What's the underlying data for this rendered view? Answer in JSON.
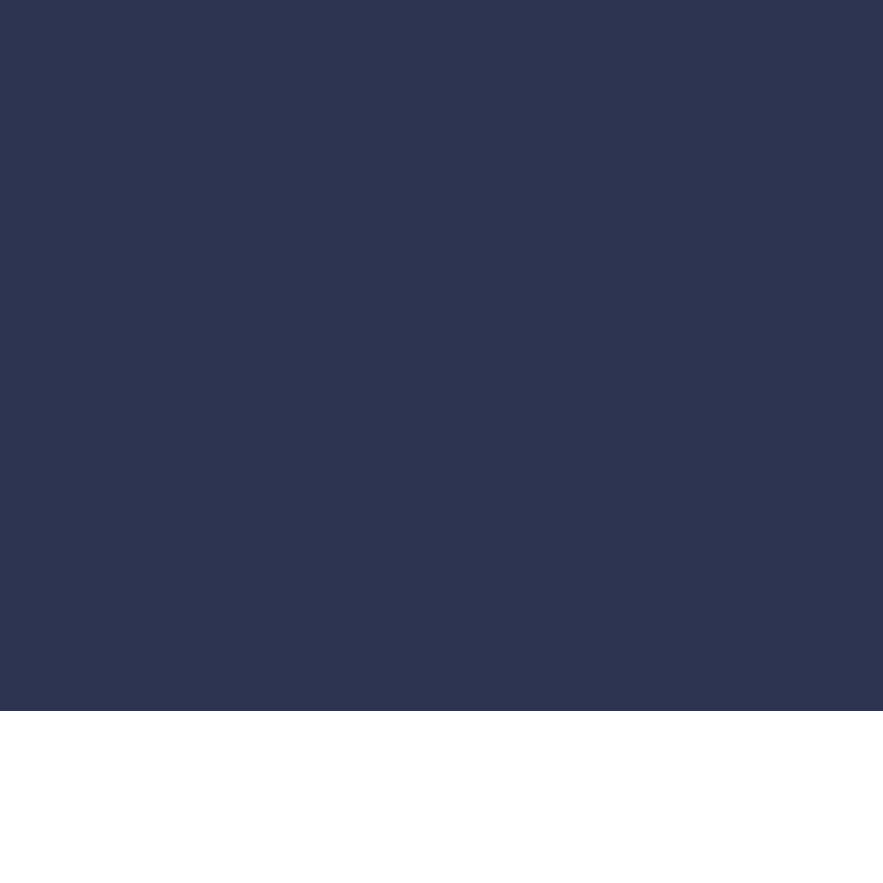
{
  "colors": {
    "hero_background": "#2D3452",
    "page_background": "#FFFFFF"
  }
}
